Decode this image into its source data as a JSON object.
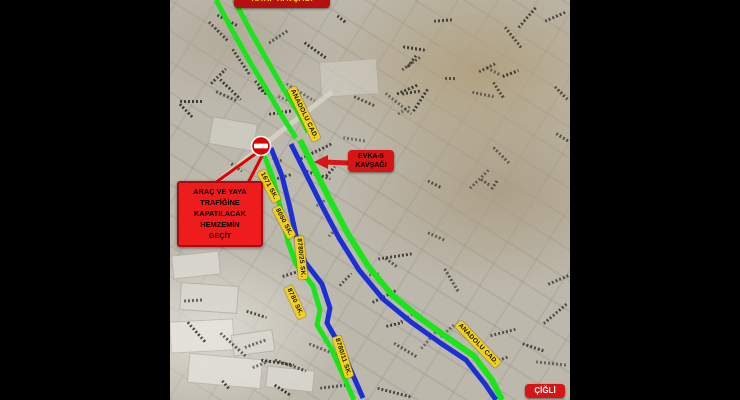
{
  "map": {
    "top_junction_label": "KATİP KAVŞAĞI",
    "evka_junction": {
      "line1": "EVKA-5",
      "line2": "KAVŞAĞI"
    },
    "district_label": "ÇİĞLİ",
    "warning_box": {
      "lines": [
        "ARAÇ VE YAYA",
        "TRAFİĞİNE",
        "KAPATILACAK",
        "HEMZEMİN",
        "GEÇİT"
      ]
    },
    "road_labels": [
      {
        "text": "ANADOLU CAD."
      },
      {
        "text": "1671 SK."
      },
      {
        "text": "8050 SK."
      },
      {
        "text": "8780/25 SK."
      },
      {
        "text": "8780 SK."
      },
      {
        "text": "8780/11 SK."
      },
      {
        "text": "ANADOLU CAD."
      }
    ],
    "routes": {
      "open_route_color": "#1ae51a",
      "detour_route_color": "#1b2fd6",
      "label_bg_color": "#f2d117",
      "warning_bg_color": "#ee1c1c",
      "closed_sign": "no-entry"
    }
  }
}
